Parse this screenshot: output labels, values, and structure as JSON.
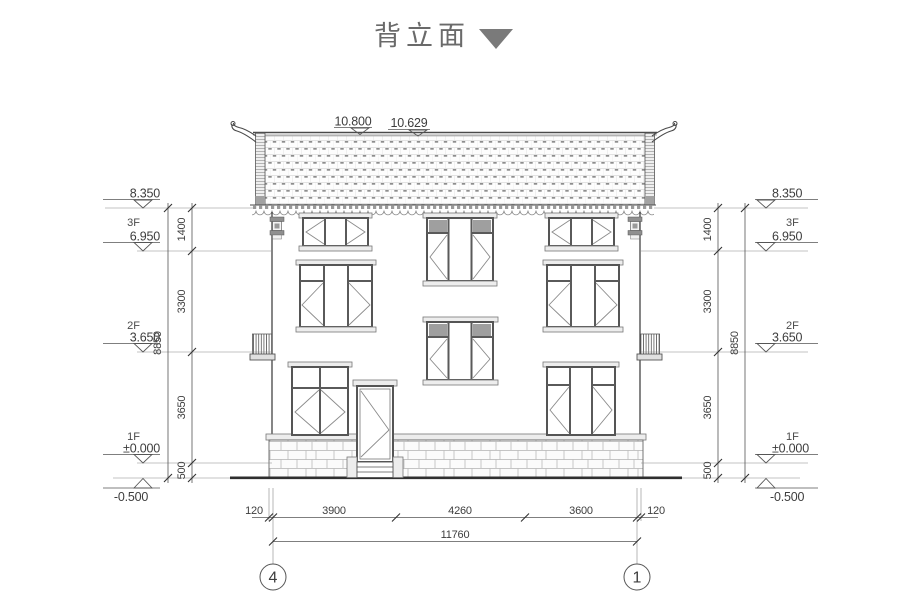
{
  "title": {
    "text": "背立面"
  },
  "roof_marks": {
    "ridge": "10.800",
    "eave": "10.629"
  },
  "levels_left": {
    "top": "8.350",
    "f3_label": "3F",
    "f3": "6.950",
    "f2_label": "2F",
    "f2": "3.650",
    "f1_label": "1F",
    "f1": "±0.000",
    "ground": "-0.500"
  },
  "levels_right": {
    "top": "8.350",
    "f3_label": "3F",
    "f3": "6.950",
    "f2_label": "2F",
    "f2": "3.650",
    "f1_label": "1F",
    "f1": "±0.000",
    "ground": "-0.500"
  },
  "dims_left": {
    "segments": [
      "1400",
      "3300",
      "3650",
      "500"
    ],
    "total": "8850"
  },
  "dims_right": {
    "segments": [
      "1400",
      "3300",
      "3650",
      "500"
    ],
    "total": "8850"
  },
  "dims_bottom": {
    "offsets": [
      "120",
      "120"
    ],
    "segments": [
      "3900",
      "4260",
      "3600"
    ],
    "total": "11760"
  },
  "axes": {
    "left": "4",
    "right": "1"
  }
}
